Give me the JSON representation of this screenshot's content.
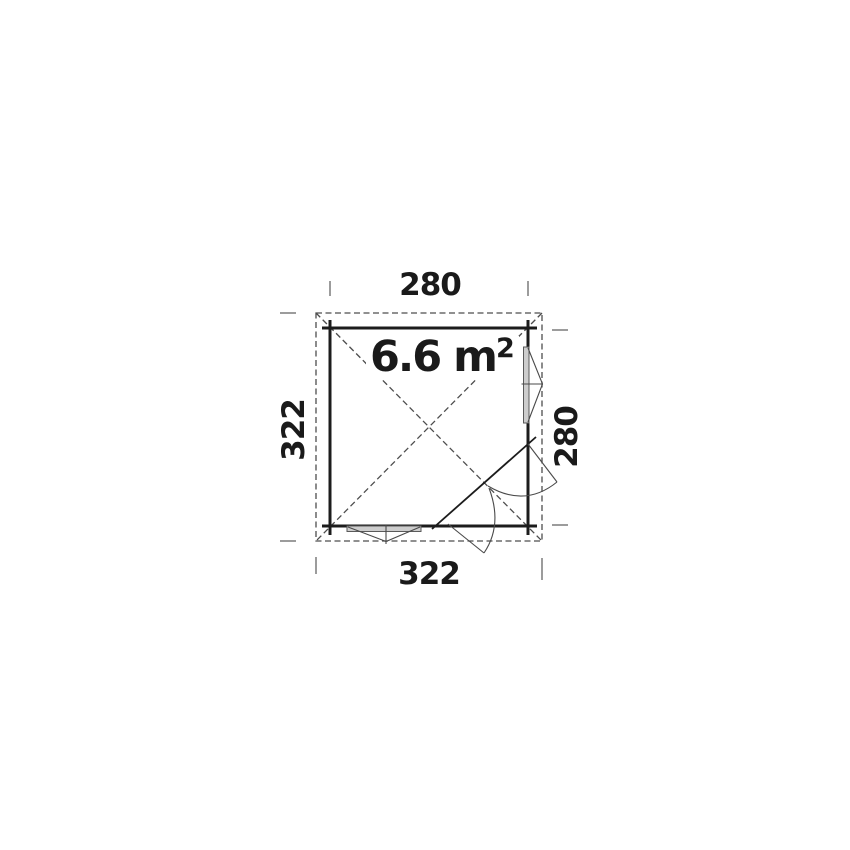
{
  "diagram": {
    "title_hint": "floor plan",
    "area_label": {
      "value": "6.6 m",
      "sup": "2"
    },
    "dim_top": "280",
    "dim_left": "322",
    "dim_right": "280",
    "dim_bottom": "322",
    "colors": {
      "wall": "#1c1c1c",
      "dashed_roof": "#4d4d4d",
      "dimension_tick": "#9c9c9c",
      "window_fill": "#cdcdcd",
      "window_stroke": "#5a5a5a",
      "door_line": "#4a4a4a",
      "text": "#1a1a1a",
      "background": "#ffffff"
    }
  }
}
